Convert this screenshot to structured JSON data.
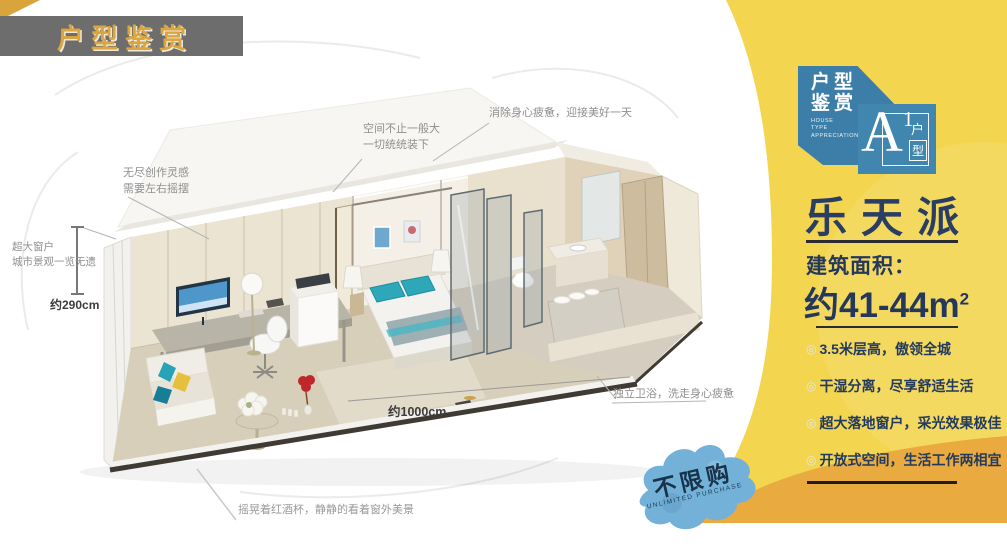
{
  "banner": {
    "title": "户型鉴赏"
  },
  "badge": {
    "cn": "户型\n鉴赏",
    "en": "HOUSE\nTYPE\nAPPRECIATION",
    "letter": "A",
    "number": "1",
    "unit_char1": "户",
    "unit_char2": "型"
  },
  "panel": {
    "title": "乐天派",
    "area_label": "建筑面积：",
    "area_value": "约41-44m",
    "area_sup": "2",
    "bullet": "◎",
    "features": [
      {
        "text": "3.5米层高，傲领全城"
      },
      {
        "text": "干湿分离，尽享舒适生活"
      },
      {
        "text": "超大落地窗户，采光效果极佳"
      },
      {
        "text": "开放式空间，生活工作两相宜"
      }
    ]
  },
  "callouts": {
    "creative": "无尽创作灵感\n需要左右摇摆",
    "space": "空间不止一般大\n一切统统装下",
    "refresh": "消除身心疲惫，迎接美好一天",
    "window": "超大窗户\n城市景观一览无遗",
    "bathroom": "独立卫浴，洗走身心疲惫",
    "wine": "摇晃着红酒杯，静静的看着窗外美景"
  },
  "dimensions": {
    "height": "约290cm",
    "width": "约1000cm"
  },
  "stamp": {
    "text": "不限购",
    "subtext": "UNLIMITED PURCHASE"
  },
  "colors": {
    "panel_yellow": "#f3d54f",
    "panel_orange": "#e8a63e",
    "badge_blue": "#3d7ea8",
    "navy_text": "#24375c",
    "banner_gray": "#6d6d6d",
    "banner_gold": "#dca53d",
    "stamp_blue": "#73b1d8",
    "teal_accent": "#2ea7b8"
  }
}
